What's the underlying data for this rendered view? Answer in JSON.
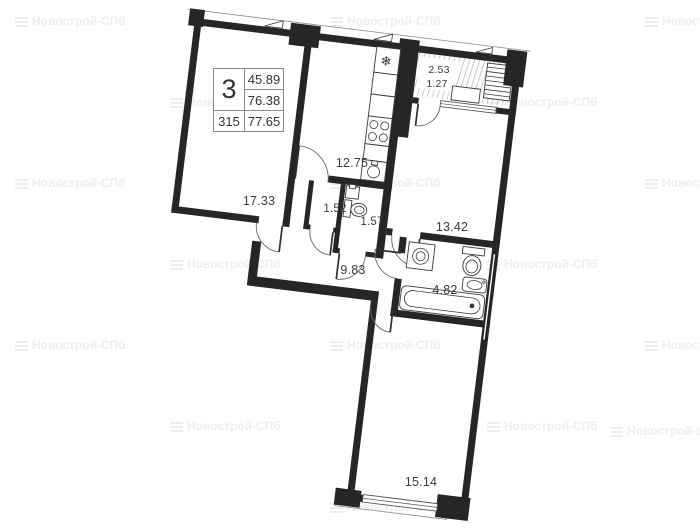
{
  "watermark": {
    "text": "Новострой-СПб"
  },
  "stamp": {
    "rooms_count": "3",
    "apartment_number": "315",
    "living_area": "45.89",
    "area_without_balcony": "76.38",
    "total_area": "77.65"
  },
  "room_labels": {
    "room1": "17.33",
    "kitchen": "12.75",
    "closet": "1.52",
    "wc": "1.57",
    "bedroom": "13.42",
    "hallway": "9.83",
    "bathroom": "4.82",
    "balcony_full": "2.53",
    "balcony_reduced": "1.27",
    "living_room": "15.14"
  },
  "icons": {
    "fridge": "❄"
  },
  "colors": {
    "wall": "#262626",
    "line": "#555555",
    "thin": "#8a8a8a",
    "watermark": "#ededed",
    "label": "#3c3c3c"
  }
}
